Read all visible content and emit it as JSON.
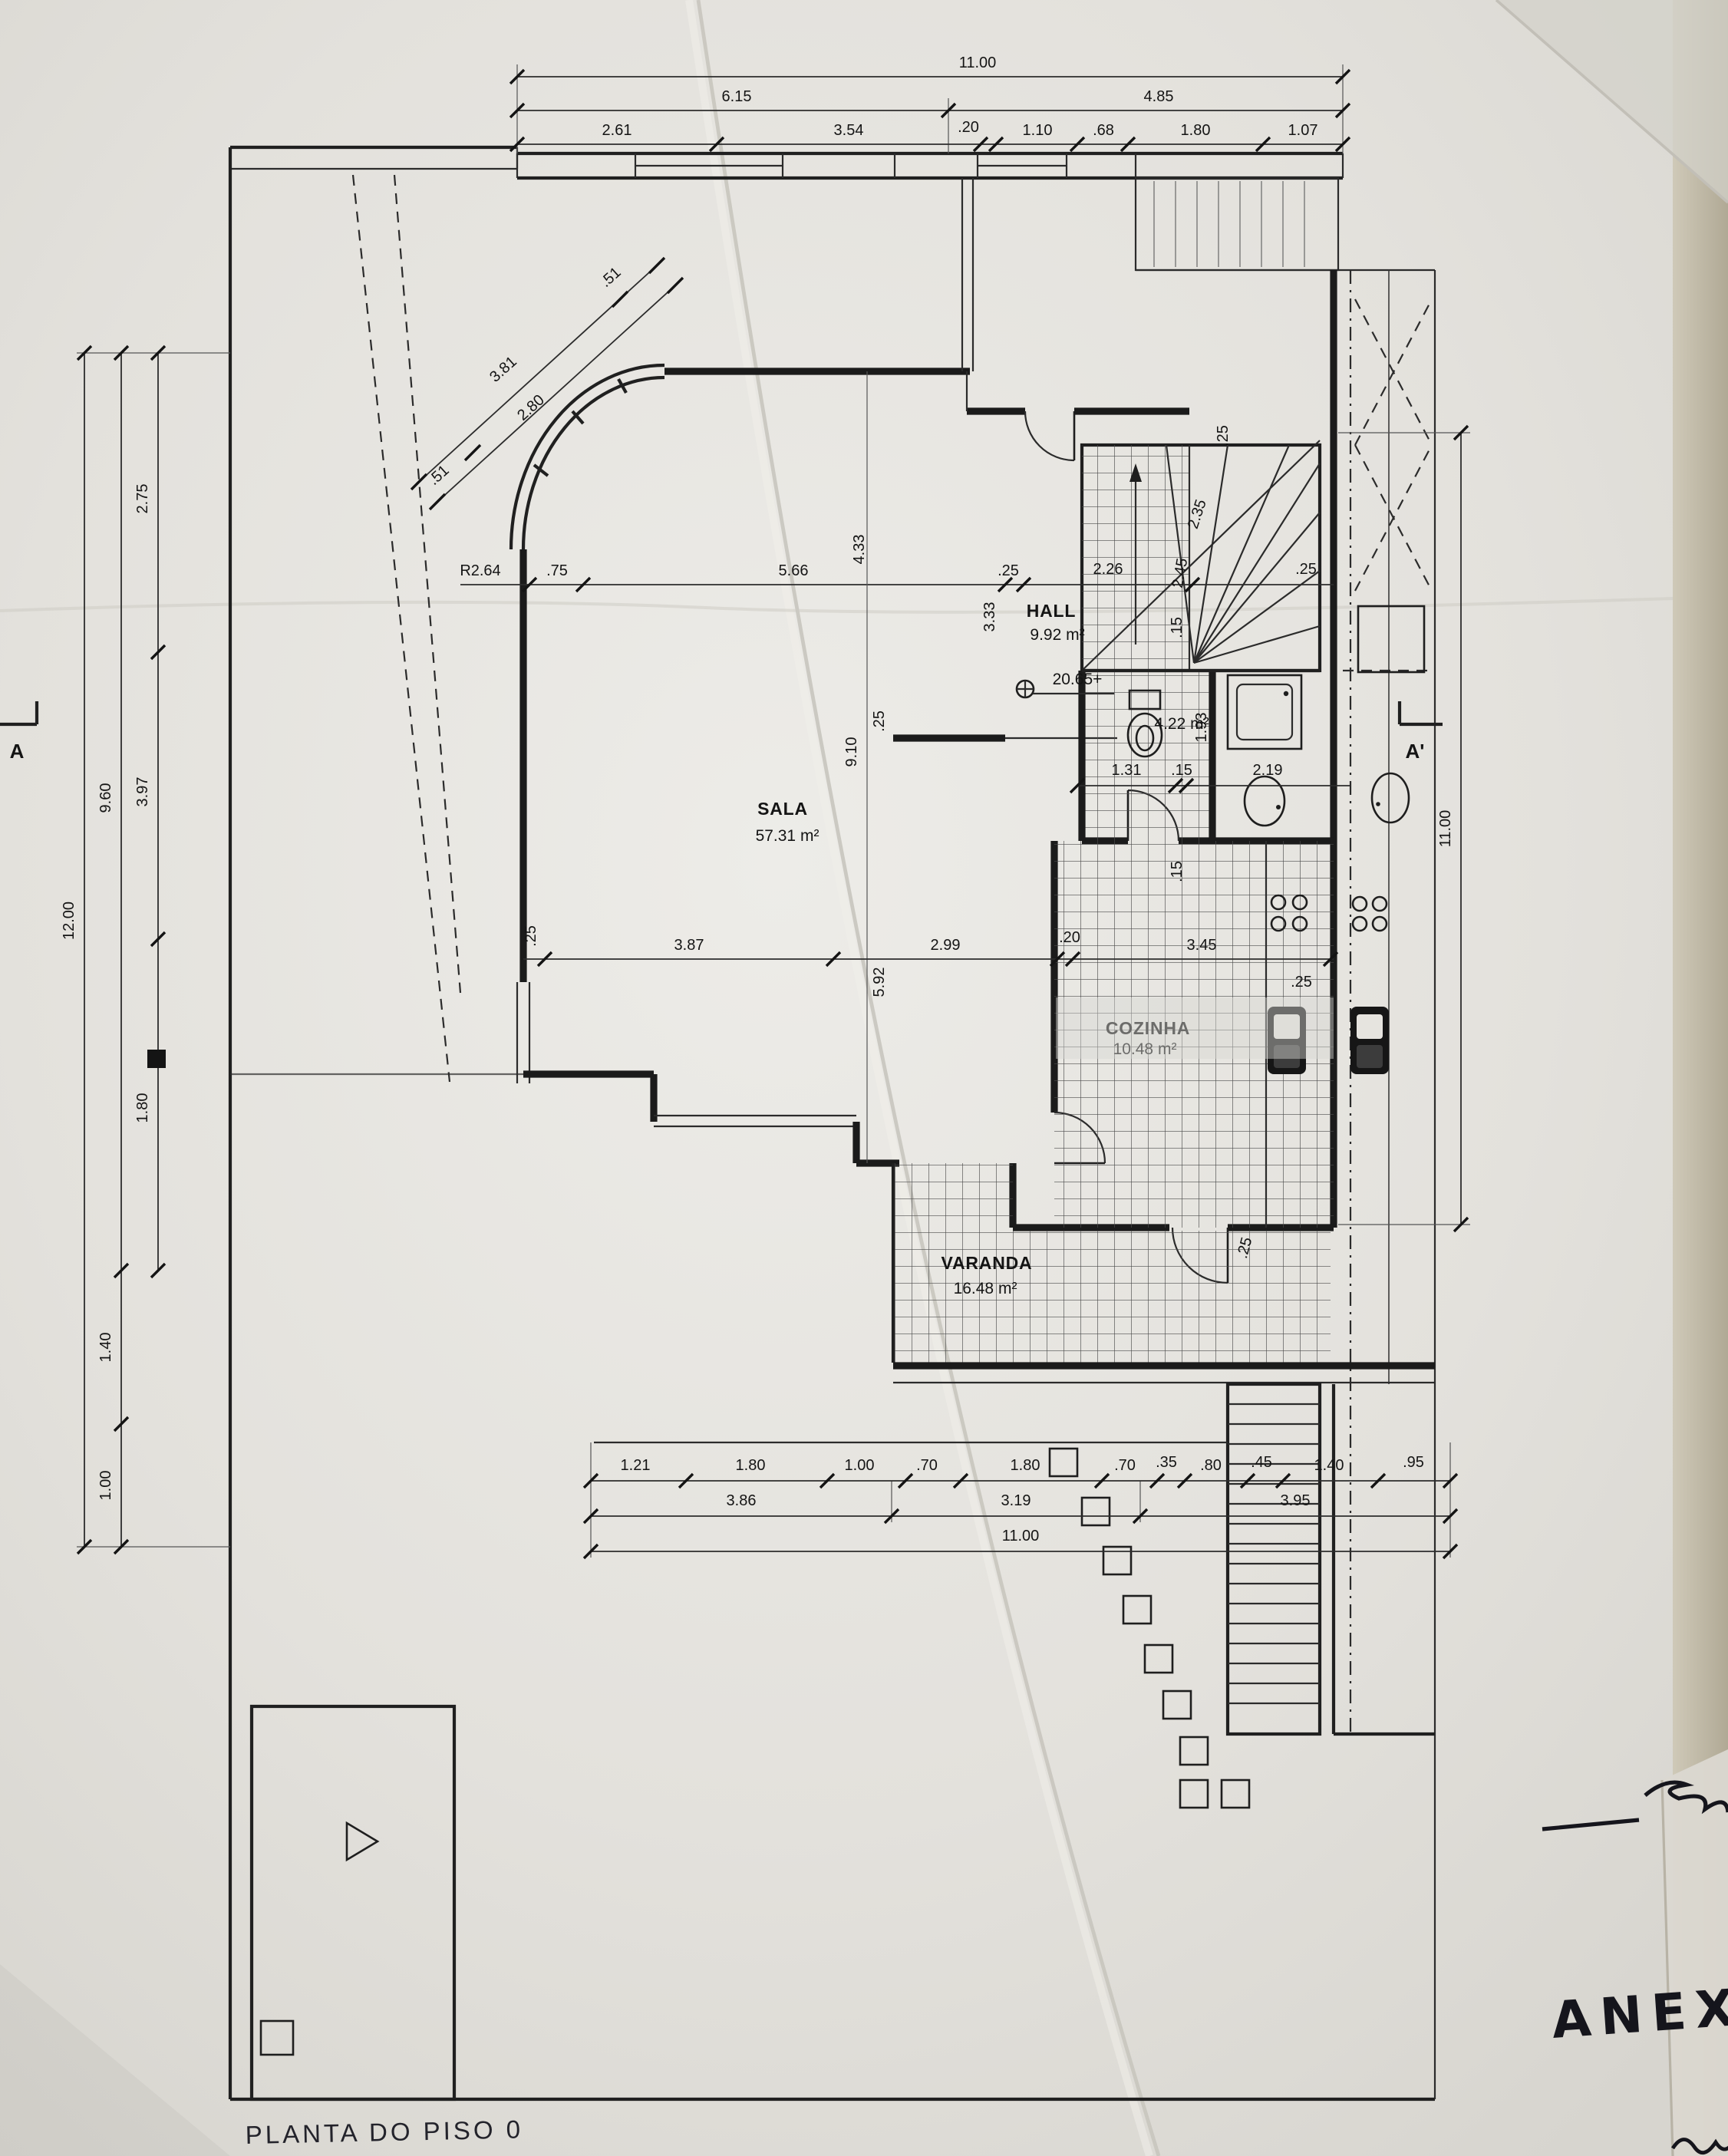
{
  "document": {
    "type_label": "PLANTA DO PISO 0",
    "handwritten_note": "ANEXO"
  },
  "section_markers": {
    "left": "A",
    "right": "A'"
  },
  "rooms": {
    "hall": {
      "name": "HALL",
      "area": "9.92 m²",
      "level_mark": "20.65+"
    },
    "sala": {
      "name": "SALA",
      "area": "57.31 m²"
    },
    "cozinha": {
      "name": "COZINHA",
      "area": "10.48 m²"
    },
    "varanda": {
      "name": "VARANDA",
      "area": "16.48 m²"
    },
    "wc": {
      "area": "4.22 m²"
    }
  },
  "dimensions": {
    "top": {
      "total": "11.00",
      "row2": [
        "6.15",
        "4.85"
      ],
      "row3": [
        "2.61",
        "3.54",
        ".20",
        "1.10",
        ".68",
        "1.80",
        "1.07"
      ]
    },
    "left": {
      "inner": [
        "2.75",
        "3.97",
        "1.80"
      ],
      "middle": [
        "9.60",
        "1.40",
        "1.00"
      ],
      "outer": "12.00"
    },
    "diagonal": [
      ".51",
      "3.81",
      "2.80",
      ".51"
    ],
    "middle_row": {
      "radius": "R2.64",
      "values": [
        ".75",
        "5.66",
        "4.33",
        ".25",
        "2.26",
        "3.33"
      ]
    },
    "stair": [
      ".25",
      "2.35",
      "2.45",
      ".15",
      ".25"
    ],
    "wc_row": [
      "1.31",
      ".15",
      "2.19",
      "1.93",
      ".15"
    ],
    "sala_dims": [
      "9.10",
      ".25",
      "5.92"
    ],
    "kitchen_row": [
      ".25",
      "3.87",
      "2.99",
      ".20",
      "3.45",
      ".25"
    ],
    "varanda_edge": ".25",
    "right": {
      "total": "11.00"
    },
    "bottom": {
      "row1": [
        "1.21",
        "1.80",
        "1.00",
        ".70",
        "1.80",
        ".70",
        ".35",
        ".80",
        ".45",
        "1.40",
        ".95"
      ],
      "row2": [
        "3.86",
        "3.19",
        "3.95"
      ],
      "total": "11.00"
    }
  }
}
